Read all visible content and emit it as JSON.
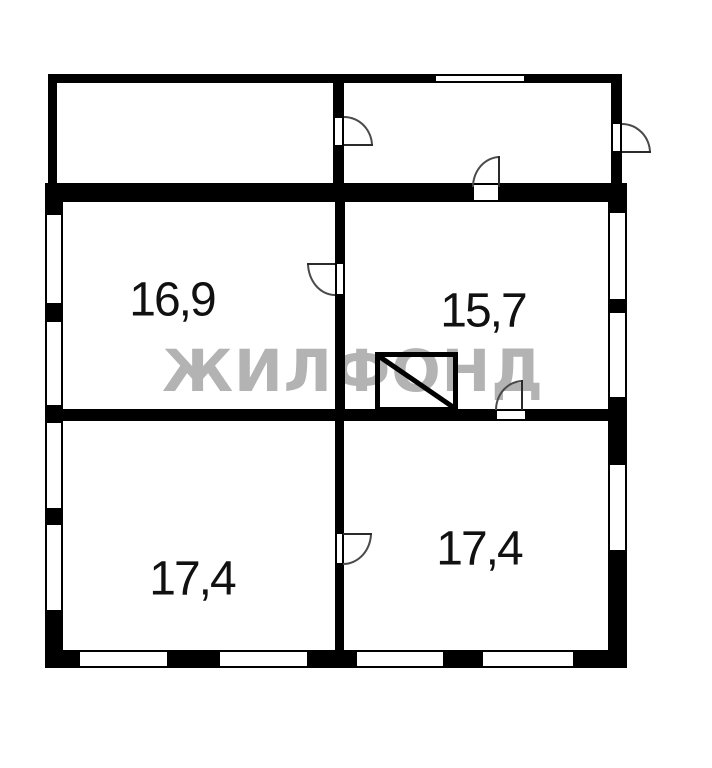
{
  "floorplan": {
    "watermark": {
      "text": "ЖИЛФОНД",
      "color": "#b3b3b3"
    },
    "rooms": [
      {
        "id": "room-middle-left",
        "area_label": "16,9"
      },
      {
        "id": "room-middle-right",
        "area_label": "15,7"
      },
      {
        "id": "room-bottom-left",
        "area_label": "17,4"
      },
      {
        "id": "room-bottom-right",
        "area_label": "17,4"
      }
    ],
    "colors": {
      "wall": "#000000",
      "background": "#ffffff",
      "door_arc": "#4a4a4a",
      "label": "#111111",
      "watermark": "#b3b3b3"
    }
  }
}
